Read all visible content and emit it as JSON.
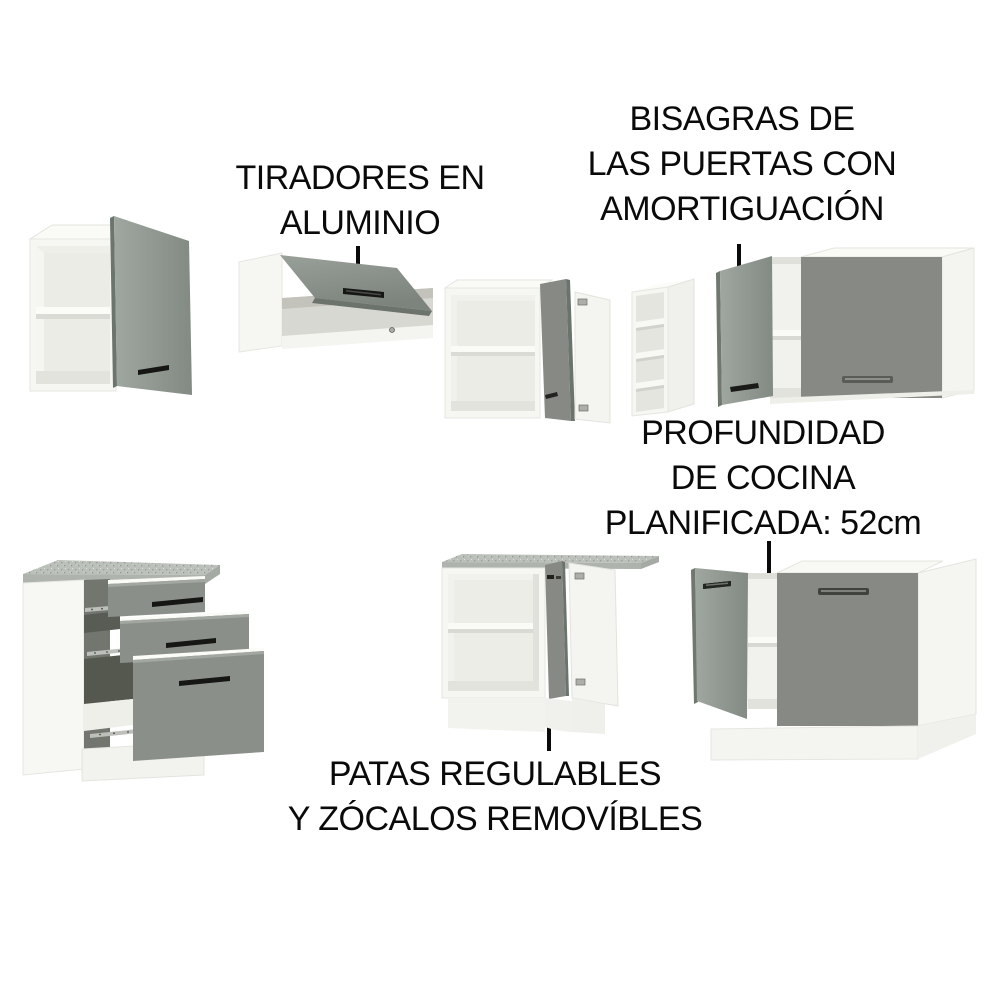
{
  "title": "kitchen-cabinet-features-diagram",
  "annotations": {
    "tiradores": {
      "line1": "TIRADORES EN",
      "line2": "ALUMINIO"
    },
    "bisagras": {
      "line1": "BISAGRAS DE",
      "line2": "LAS PUERTAS CON",
      "line3": "AMORTIGUACIÓN"
    },
    "profundidad": {
      "line1": "PROFUNDIDAD",
      "line2": "DE COCINA",
      "line3": "PLANIFICADA: 52cm"
    },
    "patas": {
      "line1": "PATAS REGULABLES",
      "line2": "Y ZÓCALOS REMOVÍBLES"
    }
  },
  "palette": {
    "door_grey": "#878A84",
    "door_grey_dark": "#6C746E",
    "door_grey_light": "#9AA19A",
    "drawer_grey": "#8B8F89",
    "carcass_white": "#F6F6F3",
    "interior_white": "#F1F1ED",
    "interior_shadow": "#DADAD4",
    "countertop_grey": "#BCC0BA",
    "handle_black": "#161614",
    "handle_aluminium": "#5A5D57",
    "text_black": "#0A0A0A",
    "background": "#FFFFFF"
  }
}
